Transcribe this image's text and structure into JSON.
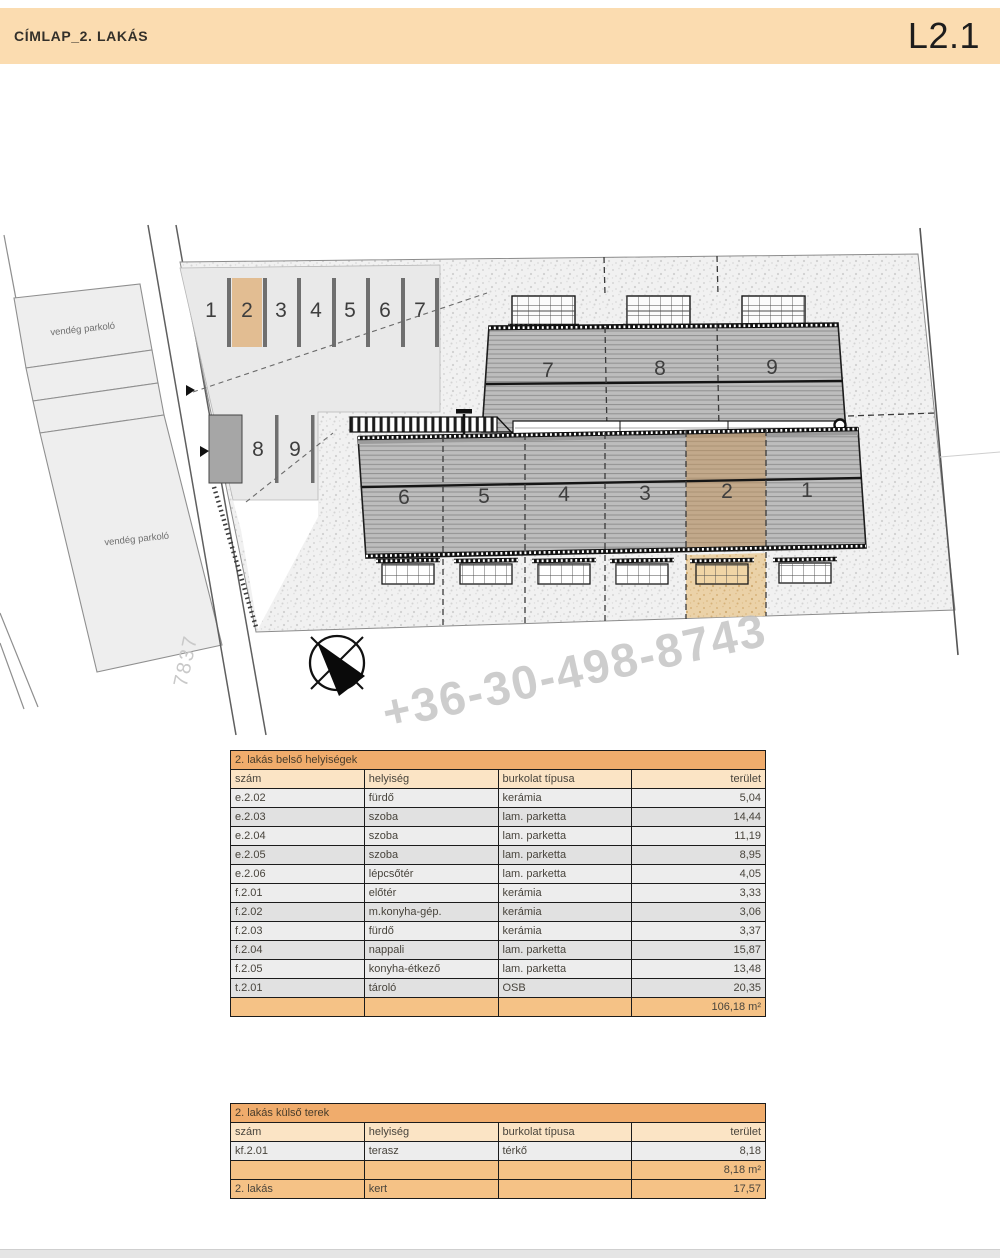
{
  "header": {
    "title": "CÍMLAP_2. LAKÁS",
    "sheet_code": "L2.1"
  },
  "plan": {
    "guest_parking_label": "vendég parkoló",
    "road_number": "7837",
    "watermark_phone": "+36-30-498-8743",
    "parking_spaces_top": [
      "1",
      "2",
      "3",
      "4",
      "5",
      "6",
      "7"
    ],
    "parking_spaces_side": [
      "8",
      "9"
    ],
    "upper_units": [
      "7",
      "8",
      "9"
    ],
    "lower_units": [
      "6",
      "5",
      "4",
      "3",
      "2",
      "1"
    ],
    "highlighted_unit": "2"
  },
  "colors": {
    "header_bar": "#fbdcb0",
    "table_title_orange": "#f0ac6c",
    "table_header_peach": "#fbe4c5",
    "table_total_orange": "#f5c286",
    "highlight_tan": "#e2bd92"
  },
  "tables": {
    "interior": {
      "title": "2. lakás belső helyiségek",
      "columns": [
        "szám",
        "helyiség",
        "burkolat típusa",
        "terület"
      ],
      "rows": [
        [
          "e.2.02",
          "fürdő",
          "kerámia",
          "5,04"
        ],
        [
          "e.2.03",
          "szoba",
          "lam. parketta",
          "14,44"
        ],
        [
          "e.2.04",
          "szoba",
          "lam. parketta",
          "11,19"
        ],
        [
          "e.2.05",
          "szoba",
          "lam. parketta",
          "8,95"
        ],
        [
          "e.2.06",
          "lépcsőtér",
          "lam. parketta",
          "4,05"
        ],
        [
          "f.2.01",
          "előtér",
          "kerámia",
          "3,33"
        ],
        [
          "f.2.02",
          "m.konyha-gép.",
          "kerámia",
          "3,06"
        ],
        [
          "f.2.03",
          "fürdő",
          "kerámia",
          "3,37"
        ],
        [
          "f.2.04",
          "nappali",
          "lam. parketta",
          "15,87"
        ],
        [
          "f.2.05",
          "konyha-étkező",
          "lam. parketta",
          "13,48"
        ],
        [
          "t.2.01",
          "tároló",
          "OSB",
          "20,35"
        ]
      ],
      "total_row": [
        "",
        "",
        "",
        "106,18 m²"
      ]
    },
    "exterior": {
      "title": "2. lakás külső terek",
      "columns": [
        "szám",
        "helyiség",
        "burkolat típusa",
        "terület"
      ],
      "rows": [
        [
          "kf.2.01",
          "terasz",
          "térkő",
          "8,18"
        ]
      ],
      "subtotal_row": [
        "",
        "",
        "",
        "8,18 m²"
      ],
      "garden_row": [
        "2. lakás",
        "kert",
        "",
        "17,57"
      ]
    }
  }
}
